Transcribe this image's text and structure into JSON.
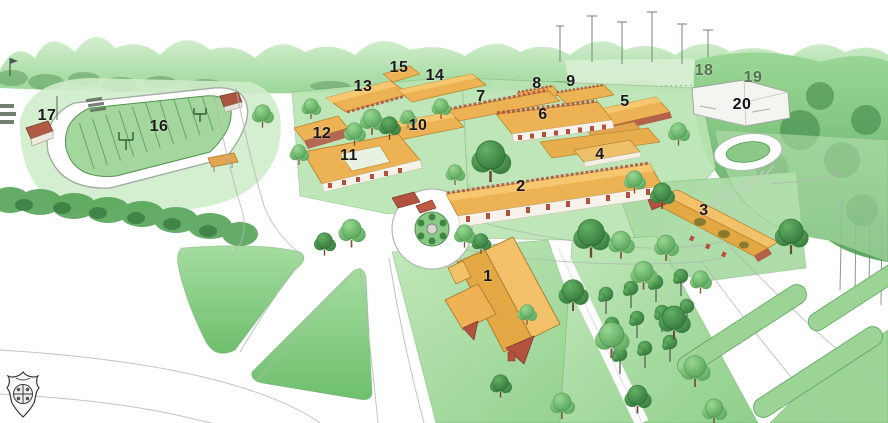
{
  "map": {
    "name": "illustrated-campus-map",
    "building_labels": [
      {
        "n": "1",
        "x": 488,
        "y": 277,
        "color": "#1a1a1a"
      },
      {
        "n": "2",
        "x": 521,
        "y": 187,
        "color": "#1a1a1a"
      },
      {
        "n": "3",
        "x": 704,
        "y": 211,
        "color": "#1a1a1a"
      },
      {
        "n": "4",
        "x": 600,
        "y": 155,
        "color": "#1a1a1a"
      },
      {
        "n": "5",
        "x": 625,
        "y": 102,
        "color": "#1a1a1a"
      },
      {
        "n": "6",
        "x": 543,
        "y": 115,
        "color": "#1a1a1a"
      },
      {
        "n": "7",
        "x": 481,
        "y": 97,
        "color": "#1a1a1a"
      },
      {
        "n": "8",
        "x": 537,
        "y": 84,
        "color": "#1a1a1a"
      },
      {
        "n": "9",
        "x": 571,
        "y": 82,
        "color": "#1a1a1a"
      },
      {
        "n": "10",
        "x": 418,
        "y": 126,
        "color": "#1a1a1a"
      },
      {
        "n": "11",
        "x": 349,
        "y": 156,
        "color": "#1a1a1a"
      },
      {
        "n": "12",
        "x": 322,
        "y": 134,
        "color": "#1a1a1a"
      },
      {
        "n": "13",
        "x": 363,
        "y": 87,
        "color": "#1a1a1a"
      },
      {
        "n": "14",
        "x": 435,
        "y": 76,
        "color": "#1a1a1a"
      },
      {
        "n": "15",
        "x": 399,
        "y": 68,
        "color": "#1a1a1a"
      },
      {
        "n": "16",
        "x": 159,
        "y": 127,
        "color": "#1a1a1a"
      },
      {
        "n": "17",
        "x": 47,
        "y": 116,
        "color": "#1a1a1a"
      },
      {
        "n": "18",
        "x": 704,
        "y": 71,
        "color": "#55714f"
      },
      {
        "n": "19",
        "x": 753,
        "y": 78,
        "color": "#55714f"
      },
      {
        "n": "20",
        "x": 742,
        "y": 105,
        "color": "#111111"
      }
    ]
  },
  "logo": {
    "icon": "school-crest-icon"
  },
  "palette": {
    "roof": "#ecb254",
    "roof_light": "#f6c76e",
    "brick": "#b2523e",
    "lawn": "#a9dba4",
    "tree_green": "#4c9b50",
    "dark_green": "#2e6f36",
    "track_white": "#ffffff",
    "road_outline": "#aeb9ae",
    "label_default": "#1a1a1a",
    "label_muted": "#55714f"
  }
}
